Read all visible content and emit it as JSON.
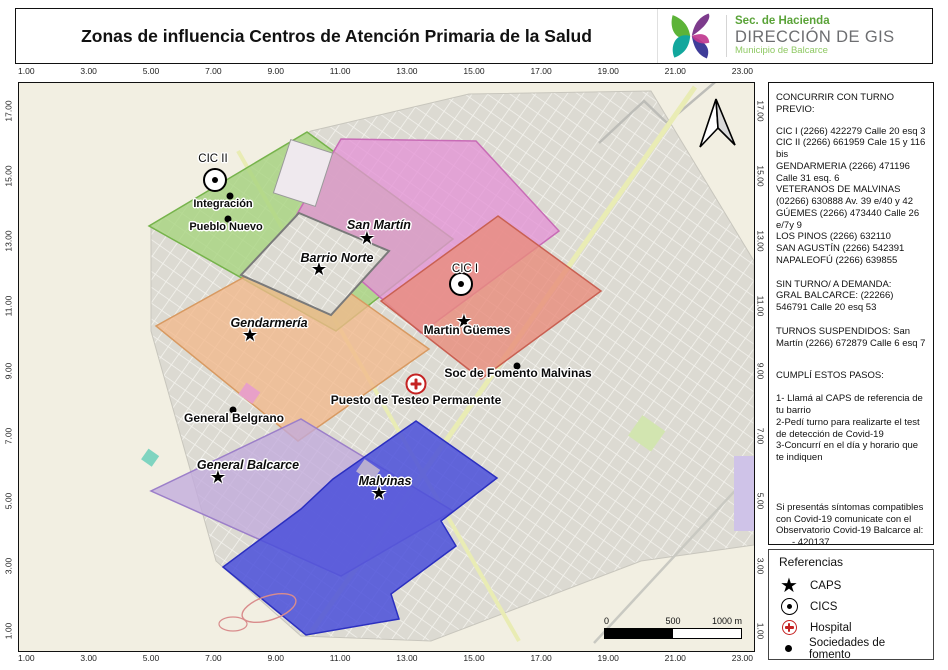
{
  "header": {
    "title": "Zonas de influencia Centros de Atención Primaria de la Salud",
    "logo": {
      "line1": "Sec. de Hacienda",
      "line2": "DIRECCIÓN DE GIS",
      "line3": "Municipio de Balcarce"
    }
  },
  "axes": {
    "x_ticks": [
      "1.00",
      "3.00",
      "5.00",
      "7.00",
      "9.00",
      "11.00",
      "13.00",
      "15.00",
      "17.00",
      "19.00",
      "21.00",
      "23.00"
    ],
    "y_ticks": [
      "17.00",
      "15.00",
      "13.00",
      "11.00",
      "9.00",
      "7.00",
      "5.00",
      "3.00",
      "1.00"
    ]
  },
  "map": {
    "labels": {
      "cic_ii": "CIC II",
      "integracion": "Integración",
      "pueblo_nuevo": "Pueblo Nuevo",
      "san_martin": "San Martín",
      "barrio_norte": "Barrio Norte",
      "cic_i": "CIC I",
      "gendarmeria": "Gendarmería",
      "martin_guemes": "Martin Güemes",
      "soc_fomento_malvinas": "Soc de Fomento Malvinas",
      "testeo": "Puesto de Testeo Permanente",
      "general_belgrano": "General Belgrano",
      "general_balcarce": "General Balcarce",
      "malvinas": "Malvinas"
    },
    "scale_bar": {
      "start": "0",
      "middle": "500",
      "end": "1000 m"
    }
  },
  "sidebar": {
    "appointment_title": "CONCURRIR CON TURNO PREVIO:",
    "appointment_lines": [
      "CIC I (2266) 422279 Calle 20 esq 3",
      "CIC II (2266) 661959 Cale 15 y 116 bis",
      "GENDARMERIA (2266) 471196 Calle 31 esq. 6",
      "VETERANOS DE MALVINAS (02266) 630888 Av. 39 e/40 y 42",
      "GÚEMES (2266) 473440 Calle 26 e/7y 9",
      "LOS PINOS (2266) 632110",
      "SAN AGUSTÍN (2266) 542391",
      "NAPALEOFÚ (2266) 639855"
    ],
    "no_turn_block": "SIN TURNO/ A  DEMANDA:",
    "no_turn_detail": "GRAL BALCARCE: (22266) 546791 Calle 20 esq 53",
    "suspended": "TURNOS SUSPENDIDOS: San Martín (2266) 672879 Calle 6 esq 7",
    "steps_title": "CUMPLÍ ESTOS PASOS:",
    "steps": [
      "1- Llamá al CAPS de referencia de tu barrio",
      "2-Pedí turno para realizarte el test de detección de Covid-19",
      "3-Concurrí en el día y horario que te indiquen"
    ],
    "covid_notice": "Si presentás síntomas  compatibles con Covid-19 comunicate  con el Observatorio Covid-19 Balcarce al:",
    "covid_phones": [
      "-  420137",
      "-  (2266) 476902",
      "-  (2266) 661833"
    ]
  },
  "legend": {
    "title": "Referencias",
    "items": [
      {
        "icon": "caps-star-icon",
        "label": "CAPS"
      },
      {
        "icon": "cics-circle-icon",
        "label": "CICS"
      },
      {
        "icon": "hospital-cross-icon",
        "label": "Hospital"
      },
      {
        "icon": "fomento-dot-icon",
        "label": "Sociedades de fomento"
      }
    ]
  },
  "colors": {
    "zone_green": "#a8d47f",
    "zone_pink": "#e493d6",
    "zone_orange": "#f2b98c",
    "zone_salmon": "#e88c7c",
    "zone_purple": "#c2abdd",
    "zone_blue": "#4a4fdb",
    "hospital_red": "#c52222",
    "road_yellow": "#e9ecb4",
    "city_gray": "#dcdad2",
    "background_beige": "#f2efe2"
  }
}
